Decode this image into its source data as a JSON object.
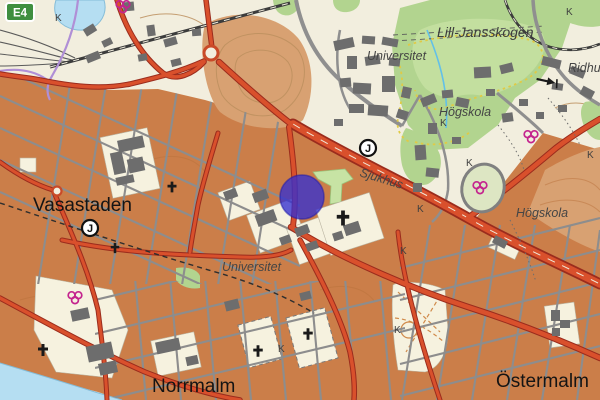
{
  "map": {
    "colors": {
      "background_cream": "#f2eede",
      "urban_orange": "#cb7e49",
      "open_orange": "#d8a172",
      "forest_green": "#b2d48f",
      "water_blue": "#b5def2",
      "road_red": "#d9502c",
      "road_casing": "#9b2c1d",
      "street_gray": "#8d8d8d",
      "building_gray": "#6d6d6d",
      "tram_purple": "#b08fd6",
      "sports_magenta": "#c4248e",
      "badge_green": "#3f8f3f",
      "marker_blue": "#3530cf"
    },
    "labels": [
      {
        "id": "vasastaden",
        "text": "Vasastaden",
        "transform": "translate(33,211)"
      },
      {
        "id": "norrmalm",
        "text": "Norrmalm",
        "transform": "translate(152,392)"
      },
      {
        "id": "ostermalm",
        "text": "Östermalm",
        "transform": "translate(496,387)"
      },
      {
        "id": "lill-jansskogen",
        "text": "Lill-Jansskogen",
        "transform": "translate(437,37)"
      },
      {
        "id": "universitet-north",
        "text": "Universitet",
        "transform": "translate(367,60)"
      },
      {
        "id": "hogskola-north",
        "text": "Högskola",
        "transform": "translate(439,116)"
      },
      {
        "id": "hogskola-east",
        "text": "Högskola",
        "transform": "translate(516,217)"
      },
      {
        "id": "universitet-central",
        "text": "Universitet",
        "transform": "translate(222,271)"
      },
      {
        "id": "sjukhus",
        "text": "Sjukhus",
        "transform": "translate(359,176) rotate(17)"
      },
      {
        "id": "ridhus",
        "text": "Ridhus",
        "transform": "translate(568,72)"
      }
    ],
    "route_badge": {
      "text": "E4"
    },
    "station_letter": "J",
    "stations": [
      {
        "x": 90,
        "y": 228
      },
      {
        "x": 368,
        "y": 148
      }
    ],
    "k_text": "K",
    "k_labels": [
      {
        "x": 55,
        "y": 21
      },
      {
        "x": 566,
        "y": 15
      },
      {
        "x": 440,
        "y": 126
      },
      {
        "x": 466,
        "y": 166
      },
      {
        "x": 417,
        "y": 212
      },
      {
        "x": 400,
        "y": 254
      },
      {
        "x": 278,
        "y": 352
      },
      {
        "x": 394,
        "y": 333
      },
      {
        "x": 587,
        "y": 158
      }
    ],
    "church_crosses": [
      {
        "x": 172,
        "y": 187,
        "s": 0.9
      },
      {
        "x": 115,
        "y": 248,
        "s": 0.85
      },
      {
        "x": 343,
        "y": 218,
        "s": 1.25
      },
      {
        "x": 258,
        "y": 351,
        "s": 0.95
      },
      {
        "x": 308,
        "y": 334,
        "s": 0.95
      },
      {
        "x": 43,
        "y": 350,
        "s": 1.0
      }
    ],
    "sports_rings": [
      {
        "x": 123,
        "y": 6
      },
      {
        "x": 75,
        "y": 297
      },
      {
        "x": 480,
        "y": 187
      },
      {
        "x": 531,
        "y": 136
      }
    ],
    "arrow_symbol": {
      "x": 537,
      "y": 77,
      "rotate": 12
    },
    "position_marker": {
      "x": 302,
      "y": 197,
      "r": 22,
      "fill": "#3530cf",
      "opacity": 0.78
    }
  }
}
